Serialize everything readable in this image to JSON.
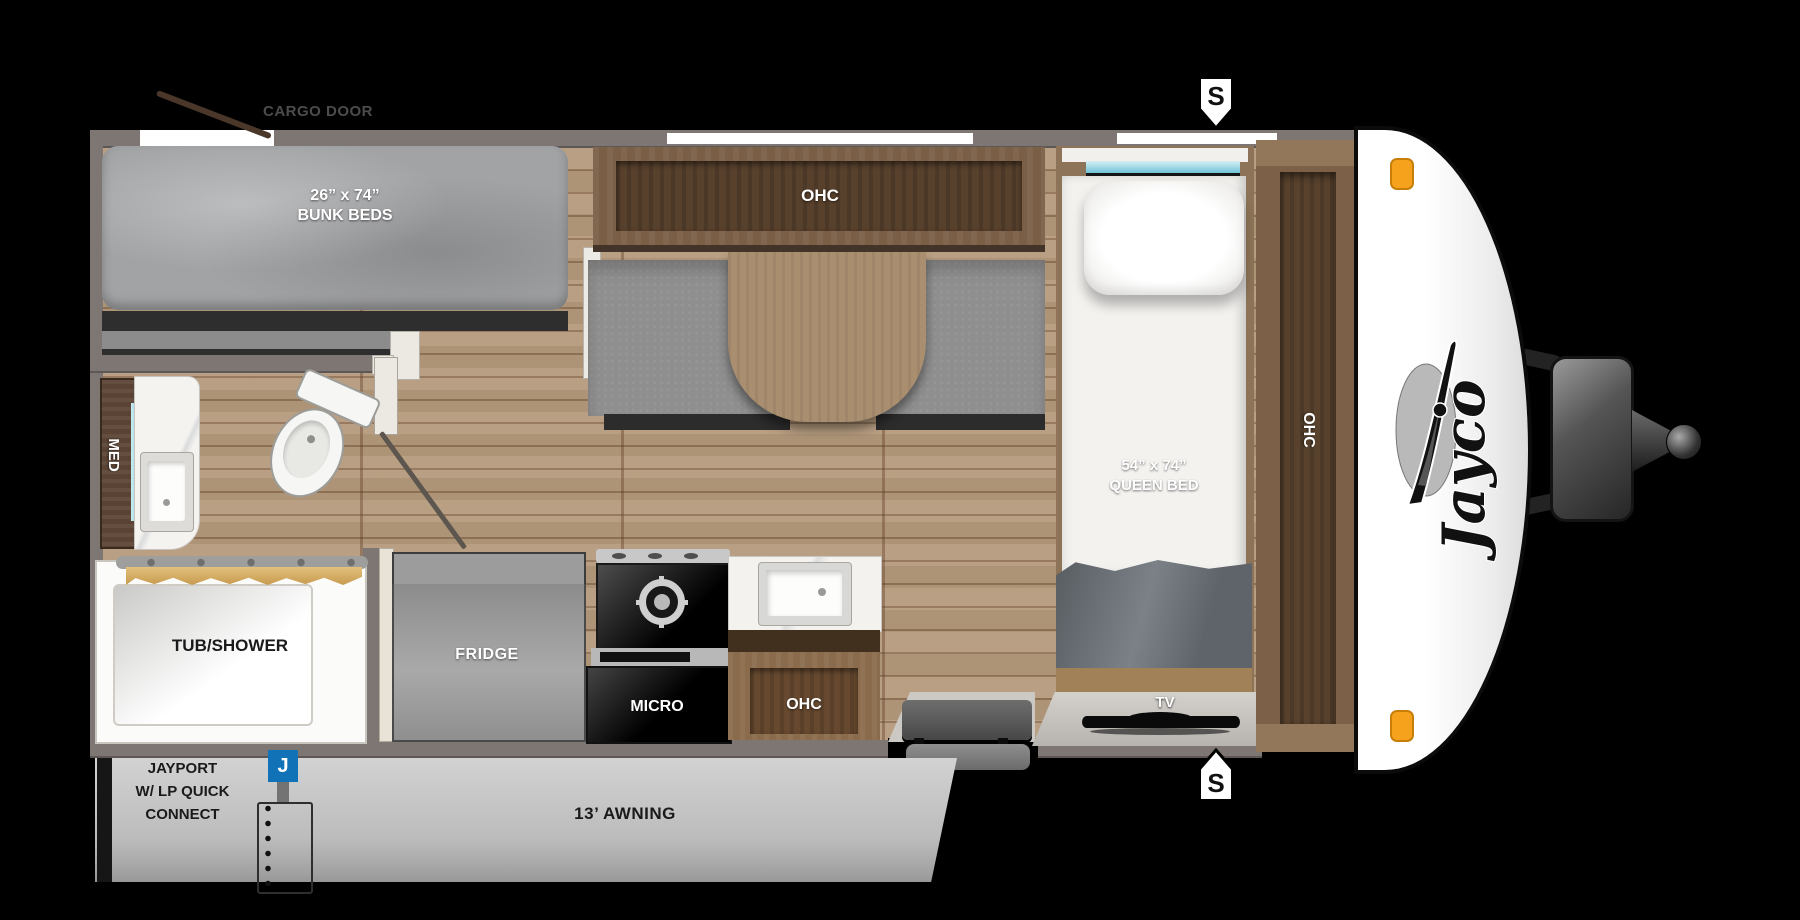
{
  "title": "Jayco Travel Trailer Floorplan",
  "brand_logo": "Jayco",
  "labels": {
    "cargo_door": "CARGO DOOR",
    "bunk_size": "26” x 74”",
    "bunk_name": "BUNK BEDS",
    "dinette_ohc": "OHC",
    "med_cabinet": "MED",
    "tub_shower": "TUB/SHOWER",
    "fridge": "FRIDGE",
    "micro": "MICRO",
    "kitchen_ohc": "OHC",
    "queen_size": "54” x 74”",
    "queen_name": "QUEEN BED",
    "wardrobe_ohc": "OHC",
    "tv": "TV",
    "speaker_top": "S",
    "speaker_bottom": "S",
    "awning": "13’ AWNING",
    "jayport_icon": "J",
    "jayport_line1": "JAYPORT",
    "jayport_line2": "W/ LP QUICK",
    "jayport_line3": "CONNECT"
  },
  "colors": {
    "background": "#000000",
    "wall_gray": "#7d7672",
    "floor_wood": "#b59a7c",
    "cabinet_wood": "#7a5f46",
    "accent_blue": "#1272b8",
    "marker_orange": "#f6a21c",
    "window_cyan": "#7fccdd"
  }
}
